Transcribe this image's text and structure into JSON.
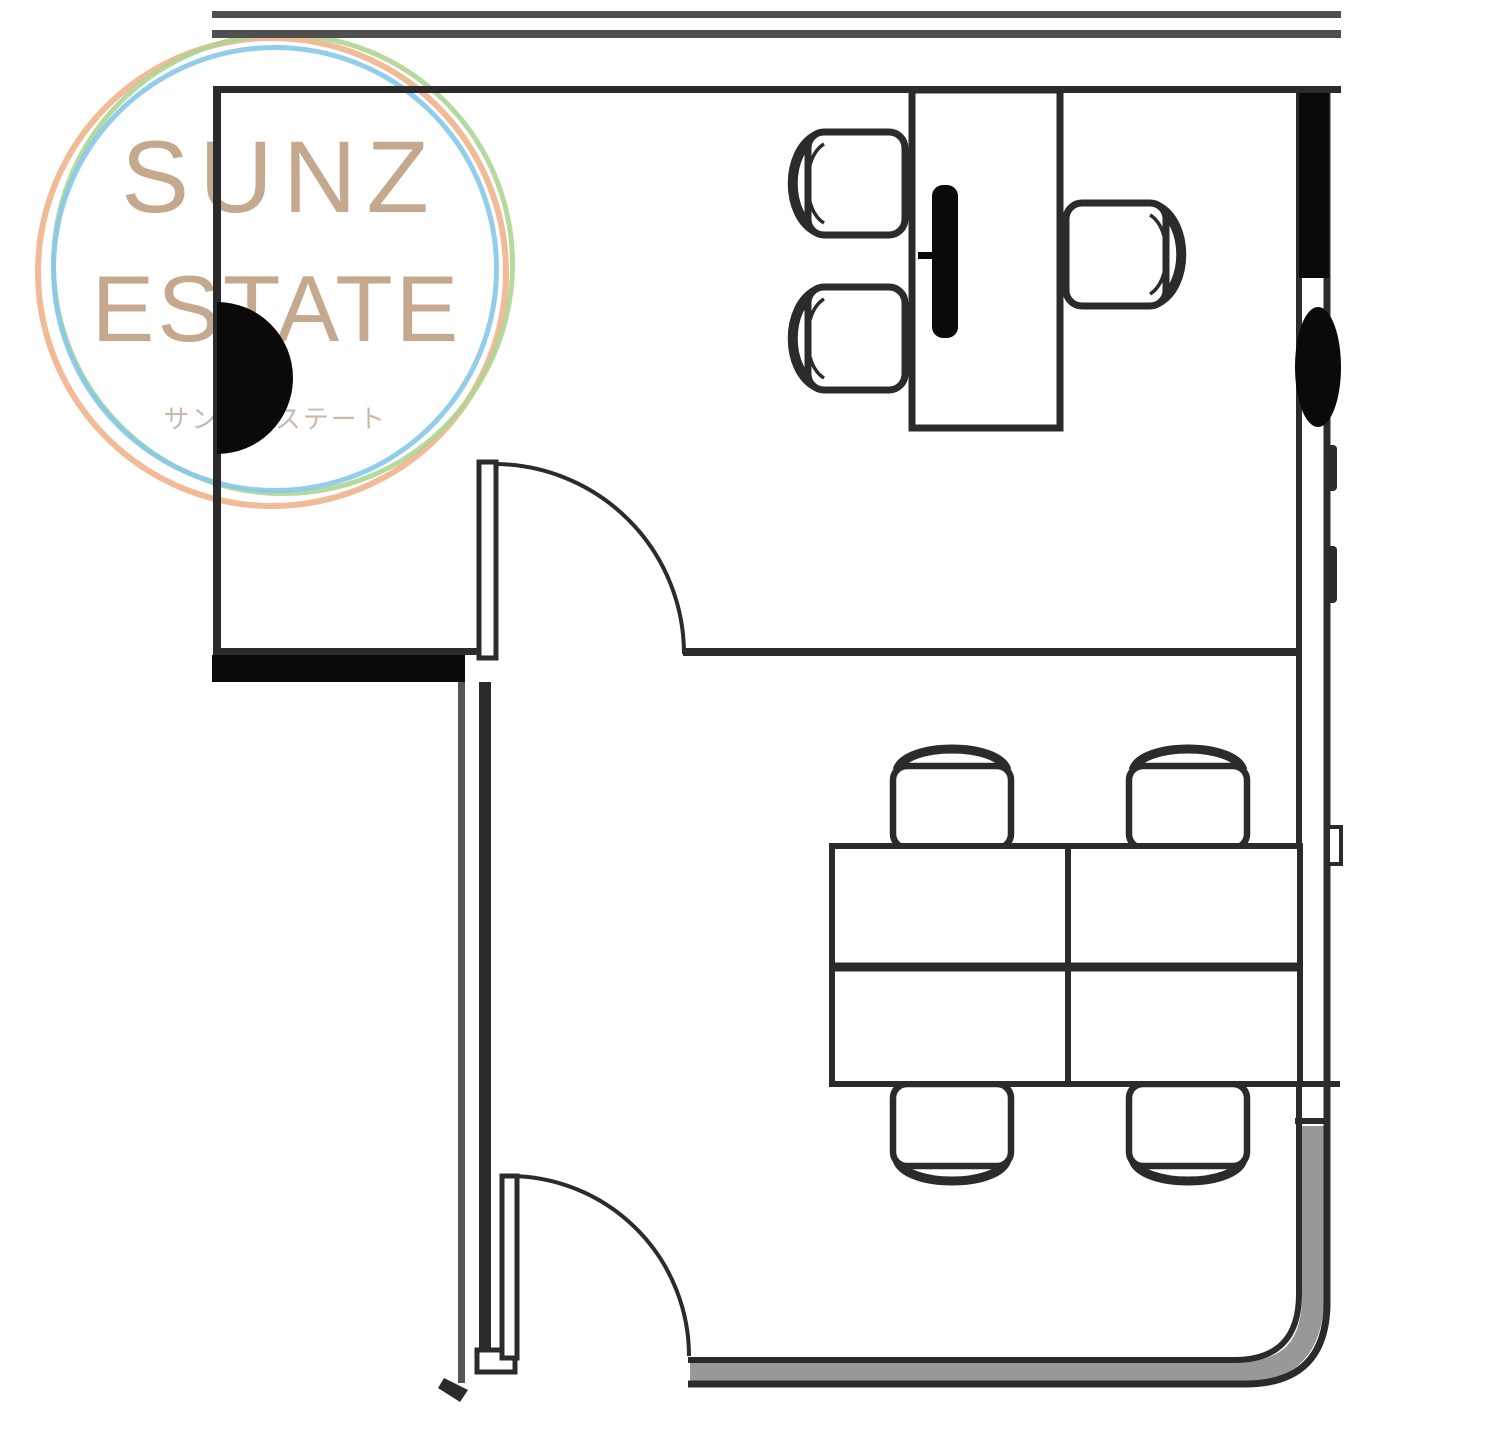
{
  "logo": {
    "name_line1": "SUNZ",
    "name_line2": "ESTATE",
    "subtitle": "サンズエステート"
  },
  "theme": {
    "ring-orange": "#f0b48d",
    "ring-green": "#aed594",
    "ring-blue": "#87c8ea",
    "logo-text": "#c2a58a",
    "logo-sub": "#c8b6a6",
    "line": "#2b2b2b",
    "line-dark": "#0a0a0a",
    "line-soft": "#555555",
    "wall-gray": "#989898",
    "band-gray": "#4f4f4f",
    "bg": "#ffffff"
  }
}
